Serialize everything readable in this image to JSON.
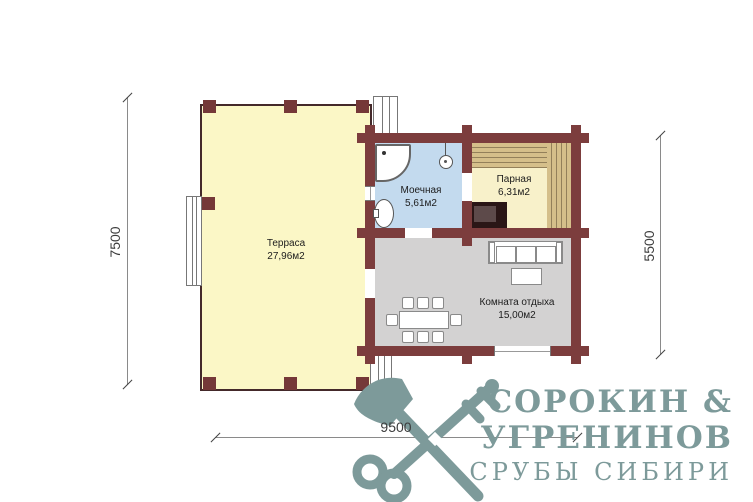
{
  "rooms": {
    "terrace": {
      "name": "Терраса",
      "area": "27,96м2"
    },
    "washroom": {
      "name": "Моечная",
      "area": "5,61м2"
    },
    "steam": {
      "name": "Парная",
      "area": "6,31м2"
    },
    "lounge": {
      "name": "Комната отдыха",
      "area": "15,00м2"
    }
  },
  "dimensions": {
    "left_mm": "7500",
    "right_mm": "5500",
    "bottom_mm": "9500"
  },
  "logo": {
    "line1": "СОРОКИН  &",
    "line2": "УГРЕНИНОВ",
    "line3": "СРУБЫ СИБИРИ"
  },
  "colors": {
    "wall": "#7c3d3d",
    "terrace_floor": "#fbf7c6",
    "washroom_floor": "#c3daee",
    "steam_floor": "#f8f1ca",
    "lounge_floor": "#d3d2d2",
    "bench_wood": "#d5bf8a",
    "stove": "#2a1616",
    "logo_teal": "#7d9a9a"
  }
}
